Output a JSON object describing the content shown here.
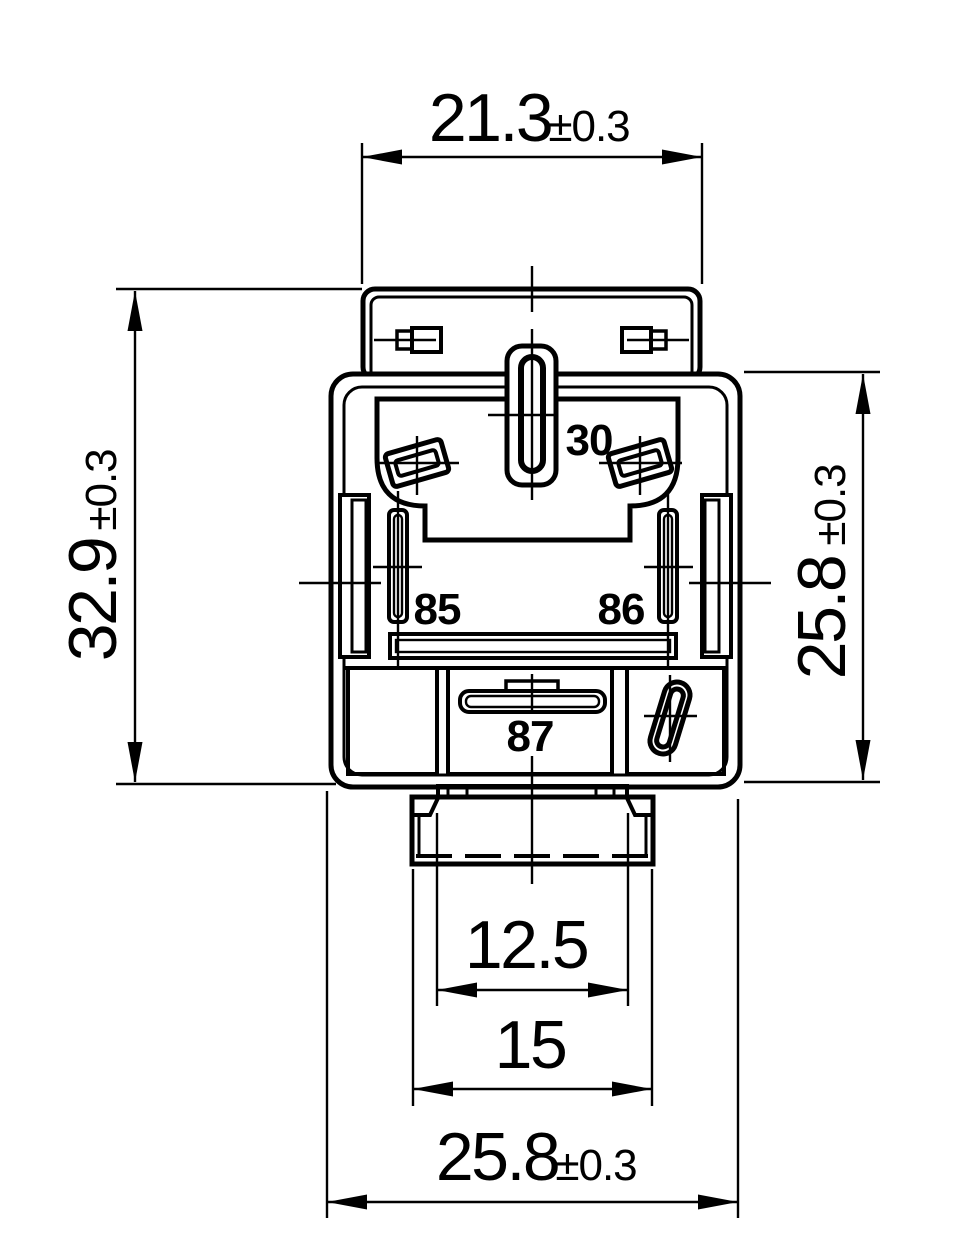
{
  "colors": {
    "line": "#000000",
    "background": "#ffffff"
  },
  "dimensions": {
    "top_width": {
      "value": "21.3",
      "tolerance": "±0.3"
    },
    "overall_height": {
      "value": "32.9",
      "tolerance": "±0.3"
    },
    "body_height": {
      "value": "25.8",
      "tolerance": "±0.3"
    },
    "key_width": {
      "value": "12.5"
    },
    "flange_width": {
      "value": "15"
    },
    "bottom_width": {
      "value": "25.8",
      "tolerance": "±0.3"
    }
  },
  "pin_labels": {
    "pin30": "30",
    "pin85": "85",
    "pin86": "86",
    "pin87": "87"
  }
}
